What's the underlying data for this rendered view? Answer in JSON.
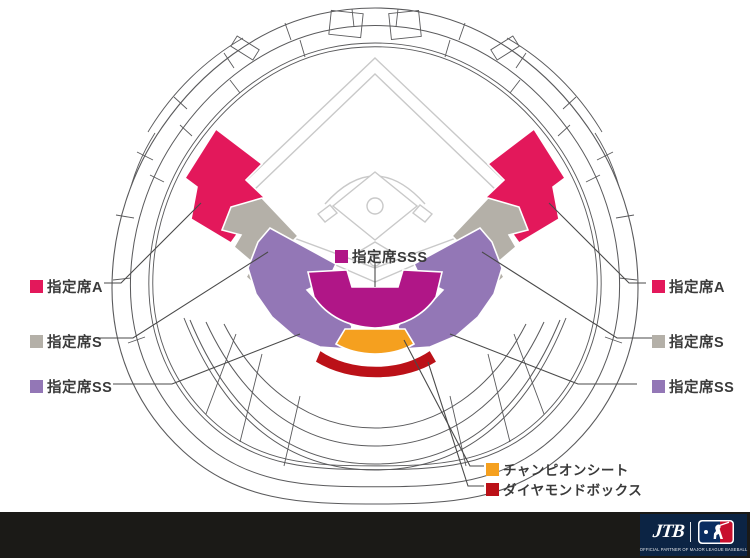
{
  "legend": {
    "left": [
      {
        "label": "指定席A"
      },
      {
        "label": "指定席S"
      },
      {
        "label": "指定席SS"
      }
    ],
    "right": [
      {
        "label": "指定席A"
      },
      {
        "label": "指定席S"
      },
      {
        "label": "指定席SS"
      }
    ],
    "center": {
      "label": "指定席SSS"
    },
    "bottom": [
      {
        "label": "チャンピオンシート"
      },
      {
        "label": "ダイヤモンドボックス"
      }
    ]
  },
  "footer": {
    "jtb_label": "JTB",
    "tagline": "OFFICIAL PARTNER OF MAJOR LEAGUE BASEBALL"
  },
  "colors": {
    "seat-a": "#e3185b",
    "seat-s": "#b4b0a8",
    "seat-ss": "#9377b6",
    "seat-sss": "#b01687",
    "champion": "#f5a01f",
    "diamond": "#bb1118",
    "outline": "#5a5a5c",
    "field-line": "#c9c9c9",
    "footer-bg": "#1b1a17",
    "panel-navy": "#0c2444",
    "mlb-red": "#c8102e",
    "mlb-blue": "#0a2d61"
  }
}
